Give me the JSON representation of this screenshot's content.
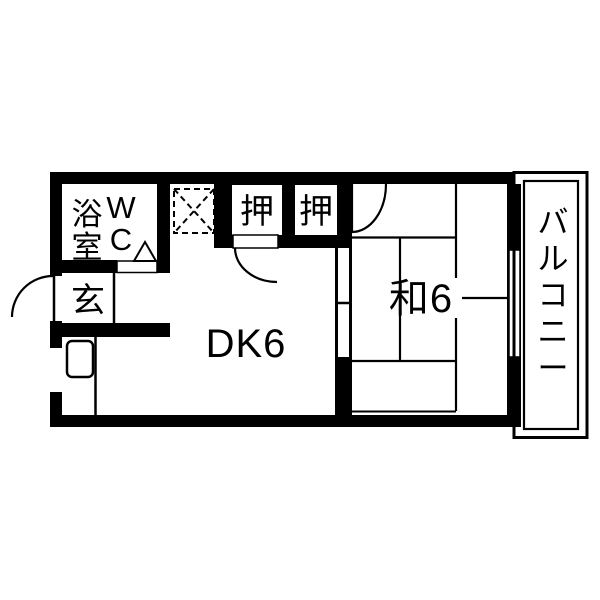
{
  "floor_plan": {
    "type": "apartment-1DK-floorplan",
    "colors": {
      "wall": "#000000",
      "floor": "#ffffff"
    },
    "rooms": {
      "bath": {
        "label": "浴室"
      },
      "wc": {
        "label": "WC"
      },
      "closet_left": {
        "label": "押"
      },
      "closet_right": {
        "label": "押"
      },
      "entrance": {
        "label": "玄"
      },
      "dining_kitchen": {
        "label": "DK6"
      },
      "japanese_room": {
        "label": "和6"
      },
      "balcony": {
        "label": "バルコニー"
      }
    }
  }
}
